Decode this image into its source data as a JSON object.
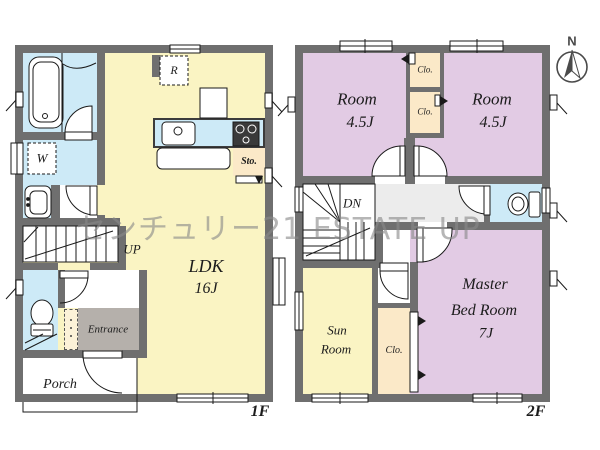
{
  "watermark": "センチュリー21 ESTATE UP",
  "compass": {
    "north_label": "N"
  },
  "floor1": {
    "floor_label": "1F",
    "ldk": {
      "name": "LDK",
      "size": "16J"
    },
    "stairs_label": "UP",
    "washroom_label": "W",
    "refrigerator_label": "R",
    "storage_label": "Sto.",
    "entrance_label": "Entrance",
    "porch_label": "Porch"
  },
  "floor2": {
    "floor_label": "2F",
    "room_left": {
      "name": "Room",
      "size": "4.5J"
    },
    "room_right": {
      "name": "Room",
      "size": "4.5J"
    },
    "closet_upper_label": "Clo.",
    "closet_lower_label": "Clo.",
    "closet_master_label": "Clo.",
    "stairs_label": "DN",
    "master": {
      "name_line1": "Master",
      "name_line2": "Bed Room",
      "size": "7J"
    },
    "sunroom": {
      "name_line1": "Sun",
      "name_line2": "Room"
    }
  },
  "palette": {
    "wall": "#6f6f6f",
    "wet_rooms_blue": "#cdeaf7",
    "ldk_yellow": "#faf4c3",
    "bedroom_purple": "#e2cbe4",
    "closet_cream": "#fbe9c8",
    "entrance_gray": "#b5b0ab",
    "hallway_gray": "#ececec",
    "watermark_gray": "#8a8a8a"
  }
}
